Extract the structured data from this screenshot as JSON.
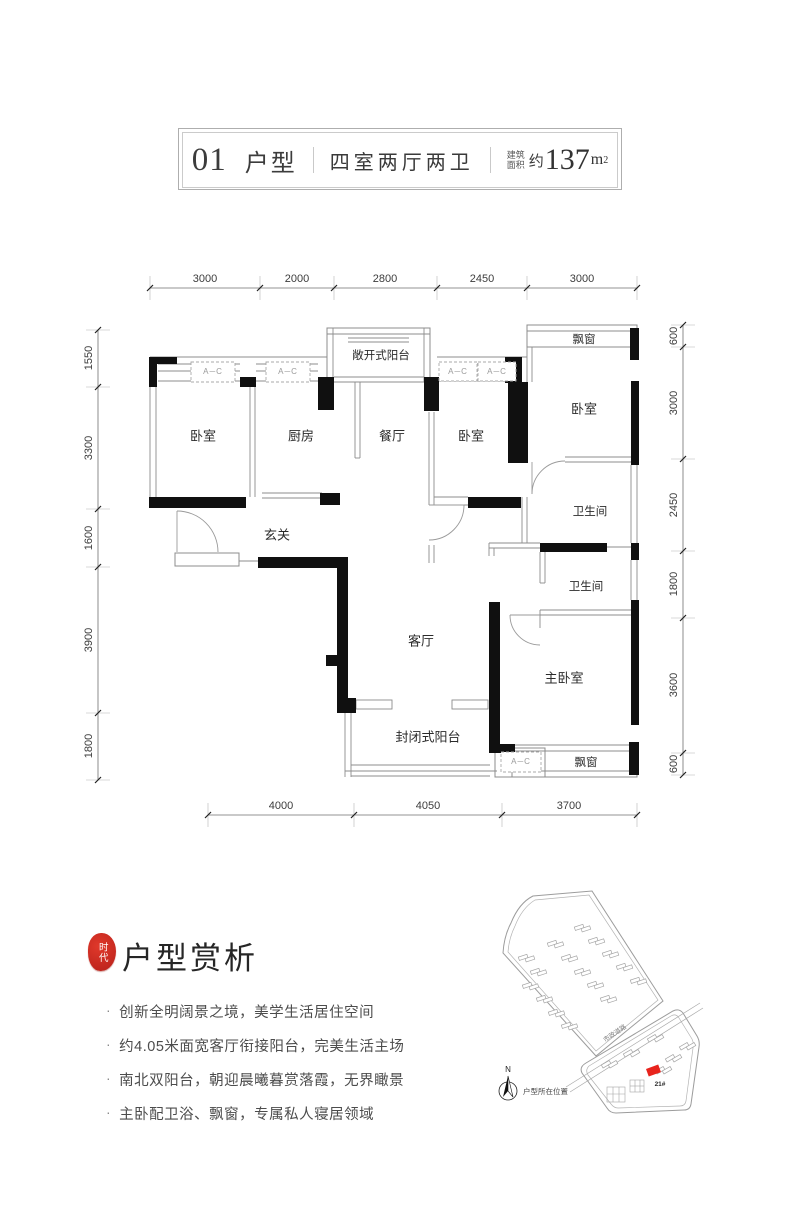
{
  "header": {
    "unit_number": "01",
    "unit_label": "户型",
    "layout_type": "四室两厅两卫",
    "area_label_line1": "建筑",
    "area_label_line2": "面积",
    "area_about": "约",
    "area_number": "137",
    "area_unit": "m",
    "area_sup": "2"
  },
  "dimensions": {
    "top": [
      "3000",
      "2000",
      "2800",
      "2450",
      "3000"
    ],
    "left": [
      "1550",
      "3300",
      "1600",
      "3900",
      "1800"
    ],
    "right": [
      "600",
      "3000",
      "2450",
      "1800",
      "3600",
      "600"
    ],
    "bottom": [
      "4000",
      "4050",
      "3700"
    ]
  },
  "plan": {
    "labels": {
      "bedroom1": "卧室",
      "kitchen": "厨房",
      "dining": "餐厅",
      "bedroom2": "卧室",
      "bedroom3": "卧室",
      "bath1": "卫生间",
      "bath2": "卫生间",
      "master": "主卧室",
      "living": "客厅",
      "entry": "玄关",
      "open_balcony": "敞开式阳台",
      "closed_balcony": "封闭式阳台",
      "bay_window_top": "飘窗",
      "bay_window_bottom": "飘窗",
      "ac_unit": "A─C"
    }
  },
  "analysis": {
    "seal_text": "时代",
    "title": "户型赏析",
    "bullet_char": "·",
    "bullets": [
      "创新全明阔景之境，美学生活居住空间",
      "约4.05米面宽客厅衔接阳台，完美生活主场",
      "南北双阳台，朝迎晨曦暮赏落霞，无界瞰景",
      "主卧配卫浴、飘窗，专属私人寝居领域"
    ]
  },
  "sitemap": {
    "road_label": "市政道路",
    "building_label": "21#",
    "compass_label": "N",
    "caption": "户型所在位置",
    "highlight_color": "#e8241d",
    "buildings_upper": [
      [
        527,
        958
      ],
      [
        539,
        972
      ],
      [
        531,
        986
      ],
      [
        545,
        999
      ],
      [
        557,
        1013
      ],
      [
        570,
        1026
      ],
      [
        556,
        944
      ],
      [
        570,
        958
      ],
      [
        583,
        972
      ],
      [
        596,
        985
      ],
      [
        609,
        999
      ],
      [
        583,
        928
      ],
      [
        597,
        941
      ],
      [
        611,
        954
      ],
      [
        625,
        967
      ],
      [
        639,
        981
      ]
    ],
    "buildings_lower": [
      [
        610,
        1064,
        -30
      ],
      [
        632,
        1053,
        -30
      ],
      [
        656,
        1038,
        -30
      ],
      [
        674,
        1058,
        -30
      ],
      [
        688,
        1046,
        -30
      ],
      [
        664,
        1070,
        -30
      ]
    ]
  }
}
